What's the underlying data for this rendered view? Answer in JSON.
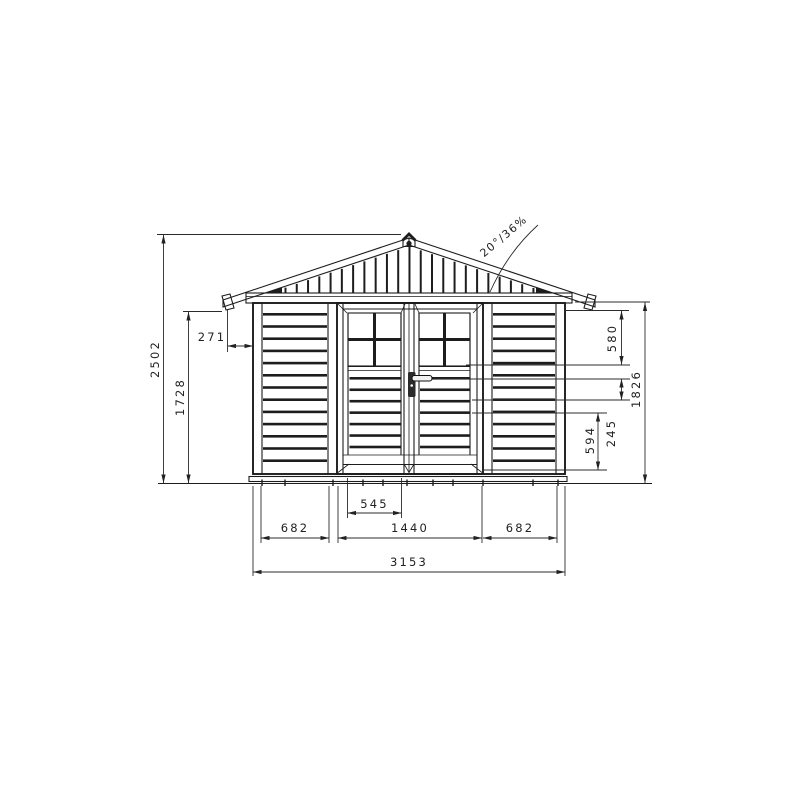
{
  "drawing": {
    "roof_slope_label": "20°/36%",
    "dims": {
      "total_height": "2502",
      "eave_height": "1728",
      "roof_overhang": "271",
      "door_window_height": "580",
      "wall_height": "1826",
      "handle_height": "245",
      "door_lower_panel": "594",
      "door_leaf_width": "545",
      "left_panel_width": "682",
      "door_width": "1440",
      "right_panel_width": "682",
      "total_width": "3153"
    }
  }
}
